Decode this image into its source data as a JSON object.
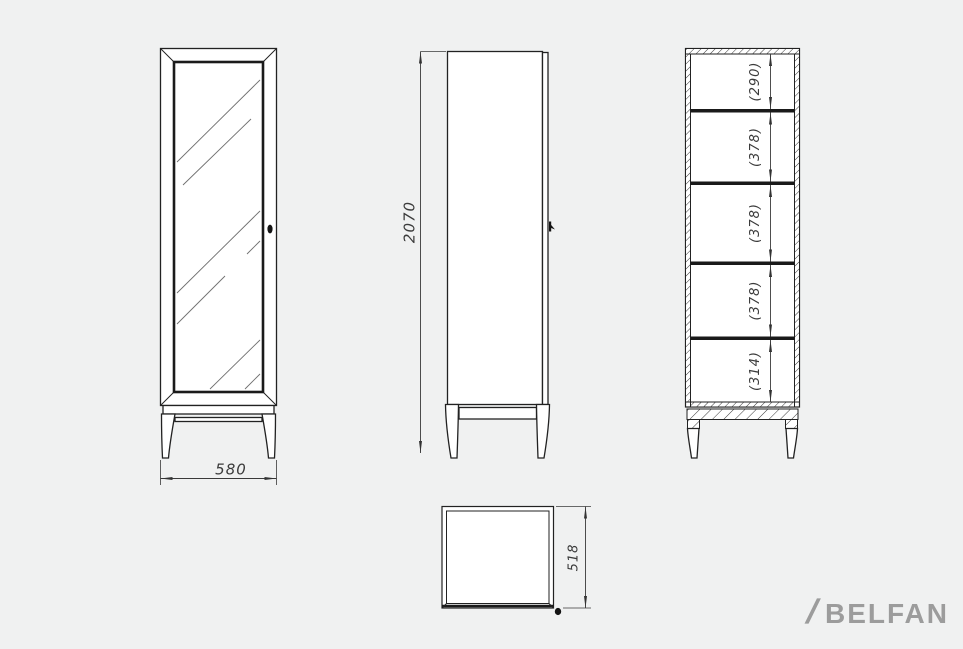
{
  "page": {
    "background_color": "#f0f1f1",
    "line_color": "#222222",
    "dim_text_color": "#3b3b3b"
  },
  "drawing": {
    "front_view": {
      "width_label": "580"
    },
    "side_view": {
      "height_label": "2070"
    },
    "section_view": {
      "compartment_labels": [
        "(290)",
        "(378)",
        "(378)",
        "(378)",
        "(314)"
      ]
    },
    "top_view": {
      "depth_label": "518"
    }
  },
  "logo": {
    "slash": "/",
    "text": "BELFAN",
    "color": "#9c9c9c"
  }
}
